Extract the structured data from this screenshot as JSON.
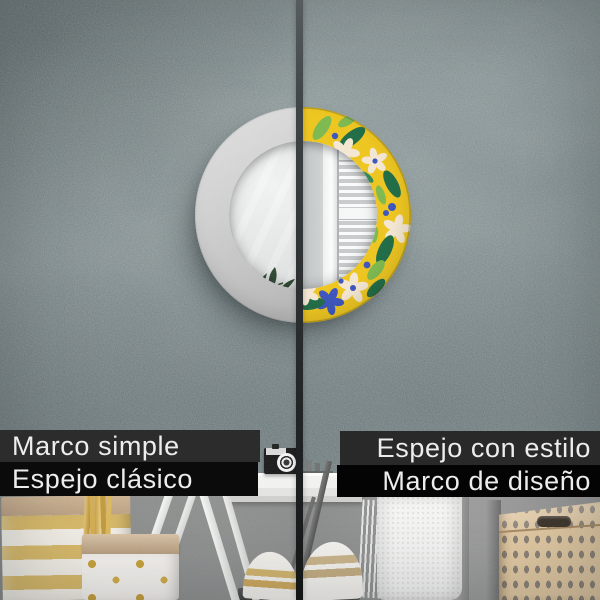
{
  "captions": {
    "left_top": "Marco simple",
    "left_bottom": "Espejo clásico",
    "right_top": "Espejo con estilo",
    "right_bottom": "Marco de diseño"
  },
  "colors": {
    "caption_bar_gray": "#2c2c2c",
    "caption_bar_black": "#0b0b0b",
    "caption_text": "#ededed",
    "wall_plaster": "#879294",
    "divider": "#303435",
    "simple_frame": "#cecece",
    "pattern_yellow": "#edc51d",
    "pattern_green_dark": "#1e6b45",
    "pattern_green_light": "#7cb84e",
    "pattern_blue": "#3b54bd",
    "pattern_cream": "#f3e6d2",
    "gold_accent": "#d9ba69",
    "basket_tan": "#e2c9a2"
  },
  "scene": {
    "left_mirror": "round mirror with plain light-gray frame",
    "right_mirror": "round mirror with tropical leaf pattern frame",
    "glass_reflection": "window with white louvered shutters",
    "decor": [
      "vintage camera on white shelf",
      "striped gold gift bag",
      "polka-dot paper bag with gold sticks",
      "white drying-rack legs",
      "striped pillows",
      "white towel",
      "tan storage basket with diamond pattern"
    ]
  }
}
